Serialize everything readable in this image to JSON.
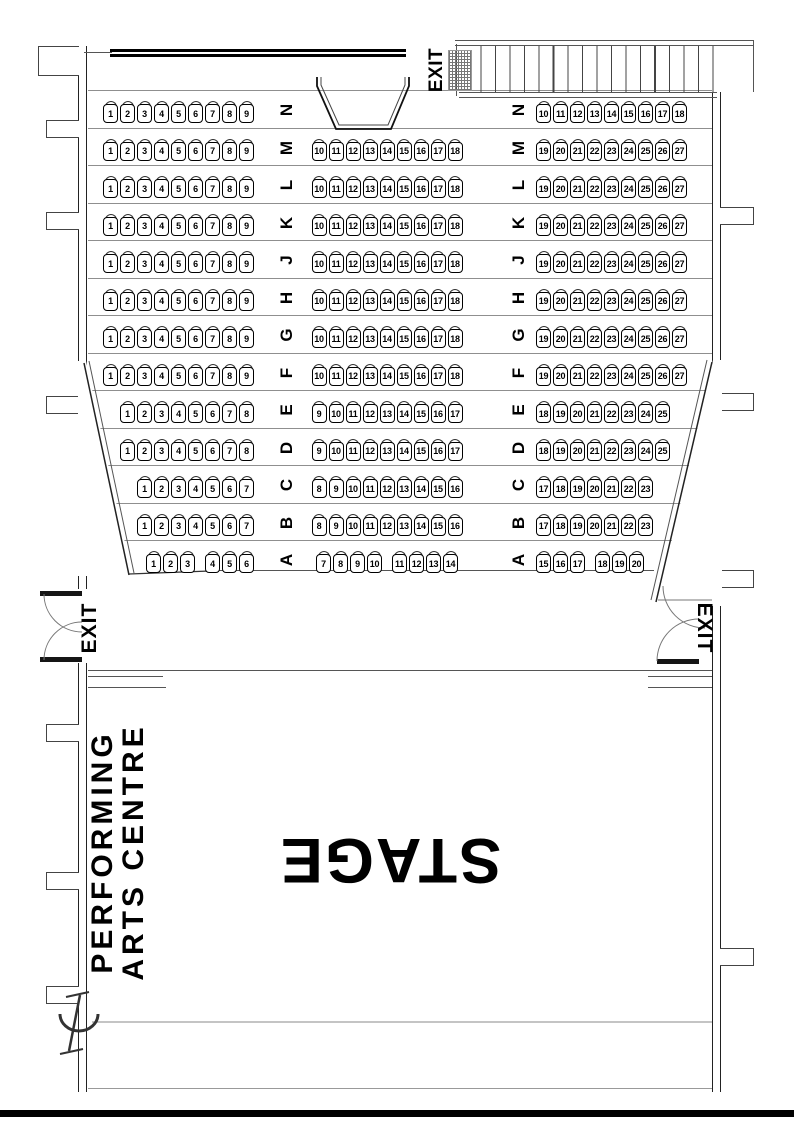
{
  "title": "Performing Arts Centre Seating Plan",
  "stage": {
    "label": "STAGE"
  },
  "venue": {
    "line1": "PERFORMING",
    "line2": "ARTS CENTRE"
  },
  "exits": {
    "stairs": "EXIT",
    "house_left": "EXIT",
    "house_right": "EXIT"
  },
  "icons": {
    "seat": "seat-top-view",
    "centerline": "centre-line-symbol",
    "door": "double-door-swing",
    "stairs": "staircase"
  },
  "seating": {
    "rows": [
      {
        "label": "N",
        "left": [
          [
            "1",
            "2",
            "3",
            "4",
            "5",
            "6",
            "7",
            "8",
            "9"
          ]
        ],
        "mid": [],
        "right": [
          [
            "10",
            "11",
            "12",
            "13",
            "14",
            "15",
            "16",
            "17",
            "18"
          ]
        ]
      },
      {
        "label": "M",
        "left": [
          [
            "1",
            "2",
            "3",
            "4",
            "5",
            "6",
            "7",
            "8",
            "9"
          ]
        ],
        "mid": [
          [
            "10",
            "11",
            "12",
            "13",
            "14",
            "15",
            "16",
            "17",
            "18"
          ]
        ],
        "right": [
          [
            "19",
            "20",
            "21",
            "22",
            "23",
            "24",
            "25",
            "26",
            "27"
          ]
        ]
      },
      {
        "label": "L",
        "left": [
          [
            "1",
            "2",
            "3",
            "4",
            "5",
            "6",
            "7",
            "8",
            "9"
          ]
        ],
        "mid": [
          [
            "10",
            "11",
            "12",
            "13",
            "14",
            "15",
            "16",
            "17",
            "18"
          ]
        ],
        "right": [
          [
            "19",
            "20",
            "21",
            "22",
            "23",
            "24",
            "25",
            "26",
            "27"
          ]
        ]
      },
      {
        "label": "K",
        "left": [
          [
            "1",
            "2",
            "3",
            "4",
            "5",
            "6",
            "7",
            "8",
            "9"
          ]
        ],
        "mid": [
          [
            "10",
            "11",
            "12",
            "13",
            "14",
            "15",
            "16",
            "17",
            "18"
          ]
        ],
        "right": [
          [
            "19",
            "20",
            "21",
            "22",
            "23",
            "24",
            "25",
            "26",
            "27"
          ]
        ]
      },
      {
        "label": "J",
        "left": [
          [
            "1",
            "2",
            "3",
            "4",
            "5",
            "6",
            "7",
            "8",
            "9"
          ]
        ],
        "mid": [
          [
            "10",
            "11",
            "12",
            "13",
            "14",
            "15",
            "16",
            "17",
            "18"
          ]
        ],
        "right": [
          [
            "19",
            "20",
            "21",
            "22",
            "23",
            "24",
            "25",
            "26",
            "27"
          ]
        ]
      },
      {
        "label": "H",
        "left": [
          [
            "1",
            "2",
            "3",
            "4",
            "5",
            "6",
            "7",
            "8",
            "9"
          ]
        ],
        "mid": [
          [
            "10",
            "11",
            "12",
            "13",
            "14",
            "15",
            "16",
            "17",
            "18"
          ]
        ],
        "right": [
          [
            "19",
            "20",
            "21",
            "22",
            "23",
            "24",
            "25",
            "26",
            "27"
          ]
        ]
      },
      {
        "label": "G",
        "left": [
          [
            "1",
            "2",
            "3",
            "4",
            "5",
            "6",
            "7",
            "8",
            "9"
          ]
        ],
        "mid": [
          [
            "10",
            "11",
            "12",
            "13",
            "14",
            "15",
            "16",
            "17",
            "18"
          ]
        ],
        "right": [
          [
            "19",
            "20",
            "21",
            "22",
            "23",
            "24",
            "25",
            "26",
            "27"
          ]
        ]
      },
      {
        "label": "F",
        "left": [
          [
            "1",
            "2",
            "3",
            "4",
            "5",
            "6",
            "7",
            "8",
            "9"
          ]
        ],
        "mid": [
          [
            "10",
            "11",
            "12",
            "13",
            "14",
            "15",
            "16",
            "17",
            "18"
          ]
        ],
        "right": [
          [
            "19",
            "20",
            "21",
            "22",
            "23",
            "24",
            "25",
            "26",
            "27"
          ]
        ]
      },
      {
        "label": "E",
        "left": [
          [
            "1",
            "2",
            "3",
            "4",
            "5",
            "6",
            "7",
            "8"
          ]
        ],
        "mid": [
          [
            "9",
            "10",
            "11",
            "12",
            "13",
            "14",
            "15",
            "16",
            "17"
          ]
        ],
        "right": [
          [
            "18",
            "19",
            "20",
            "21",
            "22",
            "23",
            "24",
            "25"
          ]
        ]
      },
      {
        "label": "D",
        "left": [
          [
            "1",
            "2",
            "3",
            "4",
            "5",
            "6",
            "7",
            "8"
          ]
        ],
        "mid": [
          [
            "9",
            "10",
            "11",
            "12",
            "13",
            "14",
            "15",
            "16",
            "17"
          ]
        ],
        "right": [
          [
            "18",
            "19",
            "20",
            "21",
            "22",
            "23",
            "24",
            "25"
          ]
        ]
      },
      {
        "label": "C",
        "left": [
          [
            "1",
            "2",
            "3",
            "4",
            "5",
            "6",
            "7"
          ]
        ],
        "mid": [
          [
            "8",
            "9",
            "10",
            "11",
            "12",
            "13",
            "14",
            "15",
            "16"
          ]
        ],
        "right": [
          [
            "17",
            "18",
            "19",
            "20",
            "21",
            "22",
            "23"
          ]
        ]
      },
      {
        "label": "B",
        "left": [
          [
            "1",
            "2",
            "3",
            "4",
            "5",
            "6",
            "7"
          ]
        ],
        "mid": [
          [
            "8",
            "9",
            "10",
            "11",
            "12",
            "13",
            "14",
            "15",
            "16"
          ]
        ],
        "right": [
          [
            "17",
            "18",
            "19",
            "20",
            "21",
            "22",
            "23"
          ]
        ]
      },
      {
        "label": "A",
        "left": [
          [
            "1",
            "2",
            "3"
          ],
          [
            "4",
            "5",
            "6"
          ]
        ],
        "mid": [
          [
            "7",
            "8",
            "9",
            "10"
          ],
          [
            "11",
            "12",
            "13",
            "14"
          ]
        ],
        "right": [
          [
            "15",
            "16",
            "17"
          ],
          [
            "18",
            "19",
            "20"
          ]
        ]
      }
    ]
  }
}
